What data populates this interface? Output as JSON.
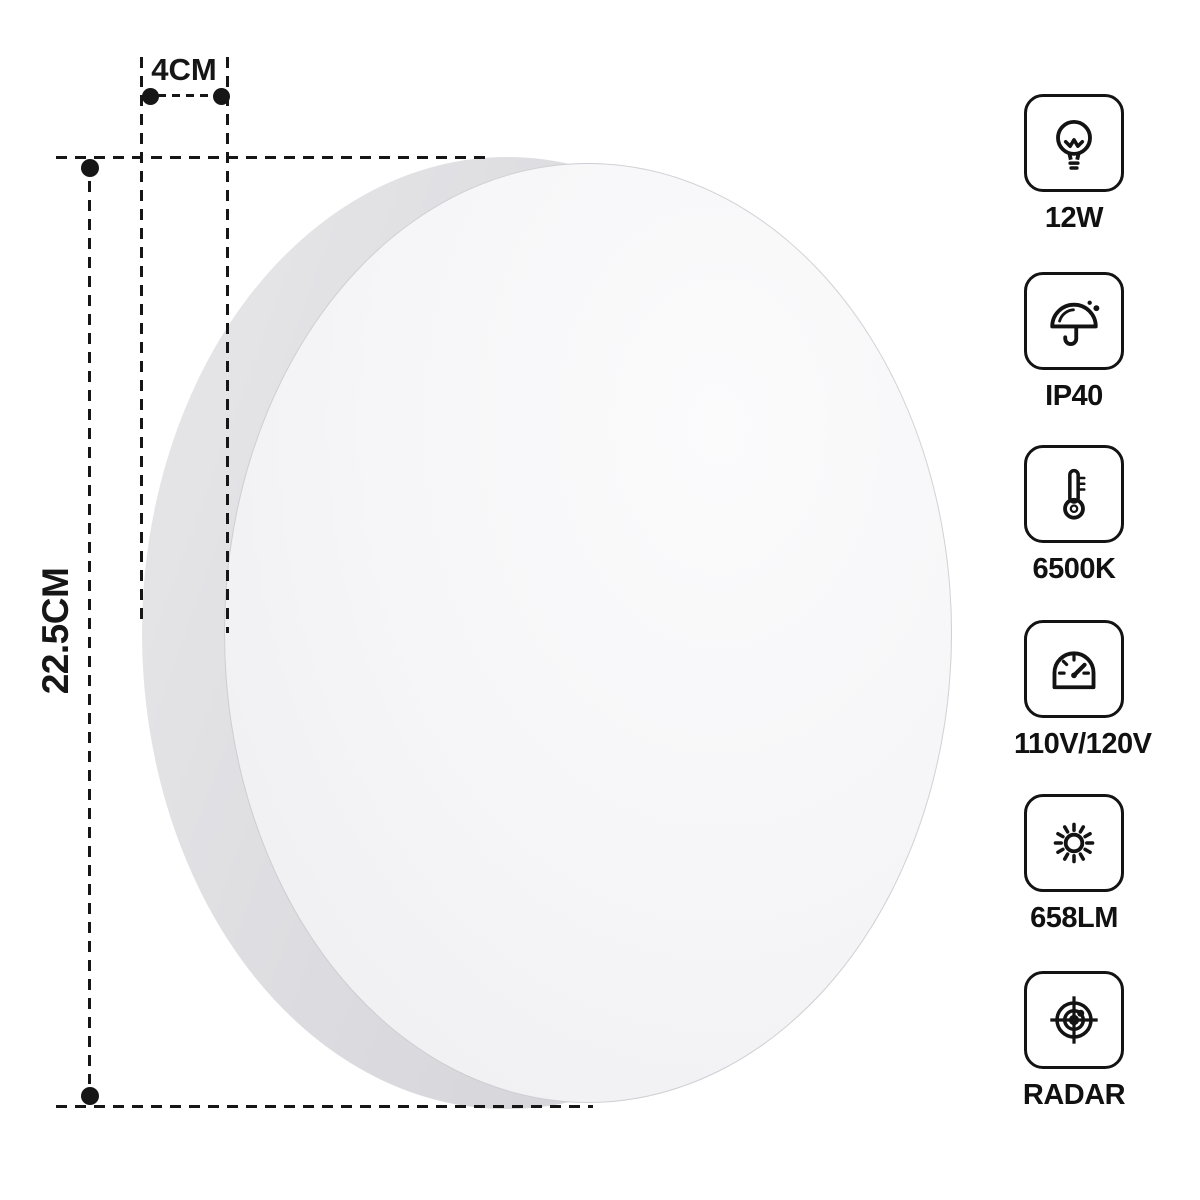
{
  "dimension_annotations": {
    "depth": "4CM",
    "diameter": "22.5CM"
  },
  "spec_badges": [
    {
      "icon": "bulb-icon",
      "label": "12W"
    },
    {
      "icon": "umbrella-rain-icon",
      "label": "IP40"
    },
    {
      "icon": "thermometer-icon",
      "label": "6500K"
    },
    {
      "icon": "gauge-icon",
      "label": "110V/120V"
    },
    {
      "icon": "sun-icon",
      "label": "658LM"
    },
    {
      "icon": "radar-icon",
      "label": "RADAR"
    }
  ],
  "colors": {
    "ink": "#161616",
    "rim_gray": "#d9d9dd",
    "face_white": "#f7f7f9",
    "background": "#ffffff"
  }
}
